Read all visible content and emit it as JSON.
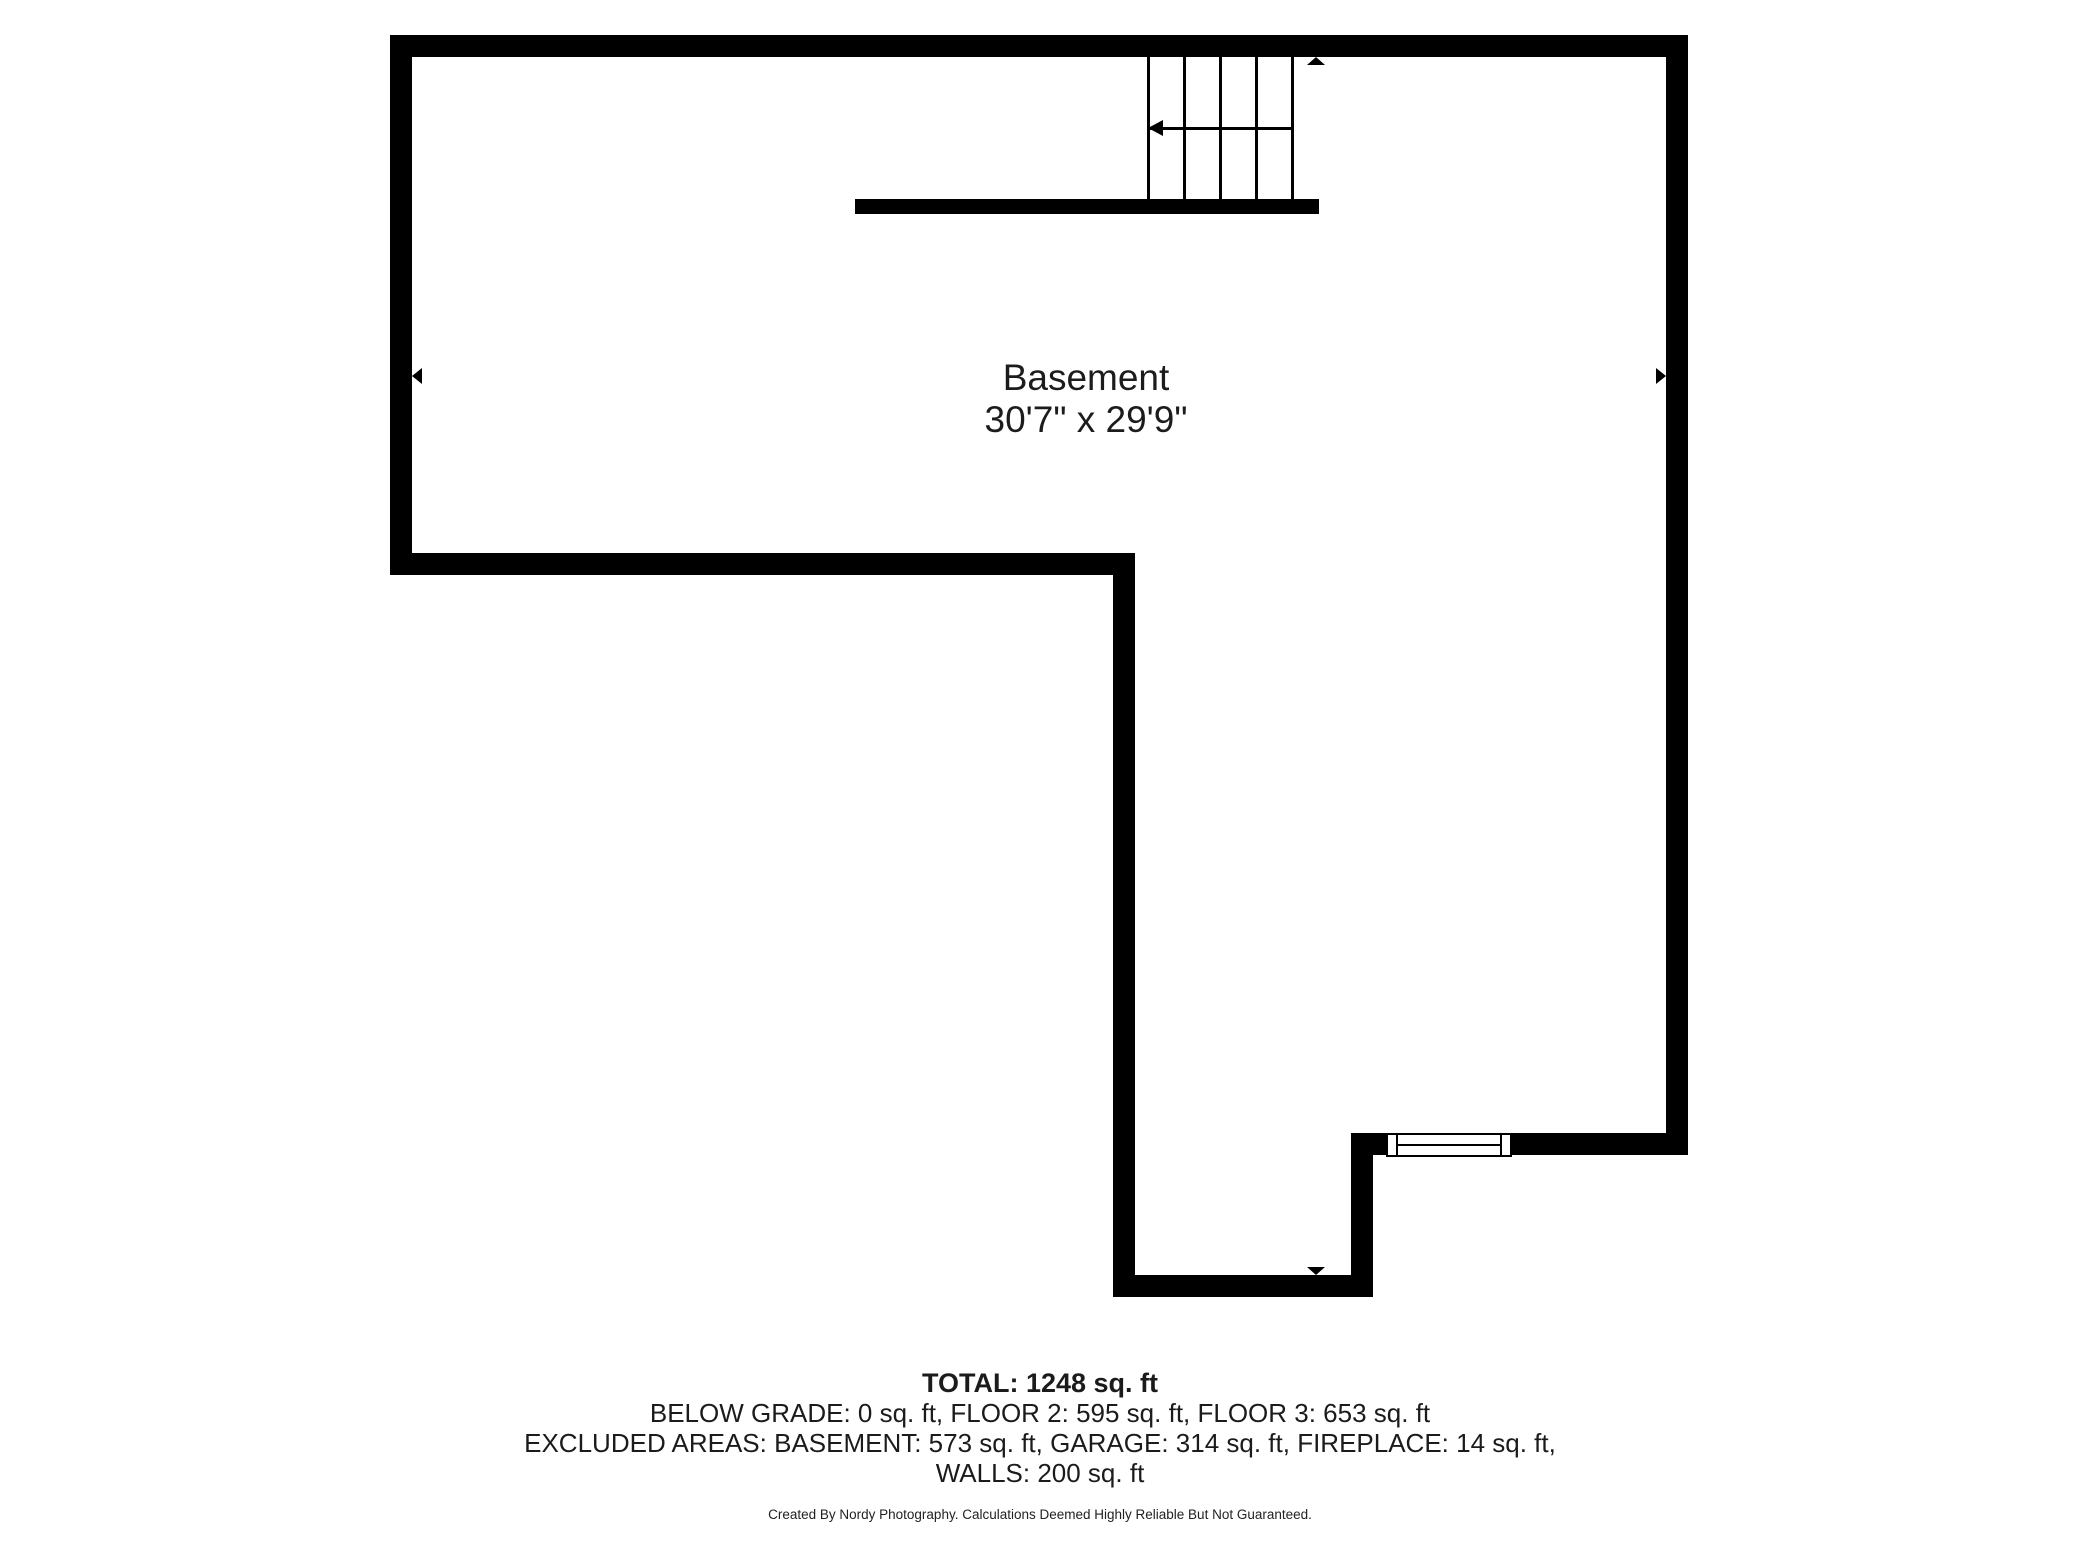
{
  "page": {
    "background_color": "#ffffff",
    "wall_color": "#000000",
    "text_color": "#1c1c1c"
  },
  "room": {
    "label": "Basement",
    "dimensions": "30'7\" x 29'9\""
  },
  "summary": {
    "total": "TOTAL: 1248 sq. ft",
    "below_grade": "BELOW GRADE: 0 sq. ft, FLOOR 2: 595 sq. ft, FLOOR 3: 653 sq. ft",
    "excluded": "EXCLUDED AREAS: BASEMENT: 573 sq. ft, GARAGE: 314 sq. ft, FIREPLACE: 14 sq. ft,",
    "walls": "WALLS: 200 sq. ft"
  },
  "footer": {
    "credit": "Created By Nordy Photography. Calculations Deemed Highly Reliable But Not Guaranteed."
  },
  "icons": {
    "stair_direction": "left-arrowhead",
    "plan_top_marker": "up-triangle",
    "plan_bottom_marker": "down-triangle",
    "dimension_left": "left-triangle",
    "dimension_right": "right-triangle"
  }
}
